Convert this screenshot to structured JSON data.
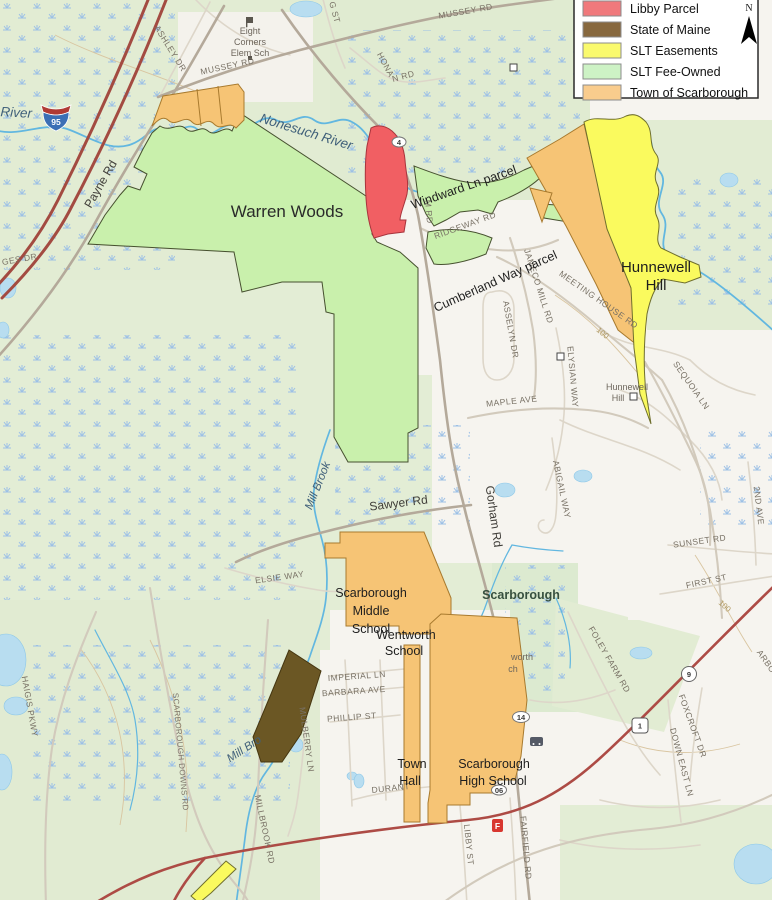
{
  "legend": {
    "items": [
      {
        "label": "Libby Parcel",
        "color": "#f0797c"
      },
      {
        "label": "State of Maine",
        "color": "#87683e"
      },
      {
        "label": "SLT Easements",
        "color": "#fafa6e"
      },
      {
        "label": "SLT Fee-Owned",
        "color": "#cdf2c5"
      },
      {
        "label": "Town of Scarborough",
        "color": "#f9cc8d"
      }
    ],
    "north_label": "N"
  },
  "map": {
    "parcel_labels": {
      "warren_woods": "Warren Woods",
      "windward_ln": "Windward Ln parcel",
      "cumberland_way": "Cumberland Way parcel",
      "hunnewell_hill": [
        "Hunnewell",
        "Hill"
      ],
      "middle_school": [
        "Scarborough",
        "Middle",
        "School"
      ],
      "wentworth_school": [
        "Wentworth",
        "School"
      ],
      "town_hall": [
        "Town",
        "Hall"
      ],
      "high_school": [
        "Scarborough",
        "High School"
      ]
    },
    "place_labels": {
      "eight_corners": [
        "Eight",
        "Corners",
        "Elem Sch"
      ],
      "hunnewell_hill_small": [
        "Hunnewell",
        "Hill"
      ],
      "scarborough_town": "Scarborough",
      "wentworth_fragment": [
        "worth",
        "ch"
      ],
      "contour_100": "100"
    },
    "water_labels": {
      "nonesuch_river": "Nonesuch River",
      "river_fragment": "River",
      "mill_brook": "Mill Brook",
      "mill_brook_fragment": "Mill Bro"
    },
    "road_labels": {
      "mussey": "MUSSEY RD",
      "ashley": "ASHLEY DR",
      "g_st": "G ST",
      "honan_1": "HONA",
      "honan_2": "N RD",
      "payne": "Payne Rd",
      "gorham": "Gorham Rd",
      "gorham_frag": "M RD",
      "ridgeway": "RIDGEWAY RD",
      "meeting_house": "MEETING HOUSE RD",
      "jameco": "JAMECO MILL RD",
      "asselyn": "ASSELYN DR",
      "elysian": "ELYSIAN WAY",
      "sequoia": "SEQUOIA LN",
      "maple": "MAPLE AVE",
      "abigail": "ABIGAIL WAY",
      "sawyer": "Sawyer Rd",
      "second_ave": "2ND AVE",
      "sunset": "SUNSET RD",
      "first_st": "FIRST ST",
      "elsie": "ELSIE WAY",
      "foley": "FOLEY FARM RD",
      "scarborough_downs": "SCARBOROUGH DOWNS RD",
      "haigis": "HAIGIS PKWY",
      "millbrook": "MILLBROOK RD",
      "mulberry": "MULBERRY LN",
      "imperial": "IMPERIAL LN",
      "barbara": "BARBARA AVE",
      "phillip": "PHILLIP ST",
      "durant": "DURANT",
      "libby_st": "LIBBY ST",
      "fairfield": "FAIRFIELD RD",
      "foxcroft": "FOXCROFT DR",
      "down_east": "DOWN EAST LN",
      "arbo_frag": "ARBO",
      "ges_frag": "GES DR"
    },
    "shields": {
      "i95": "95",
      "route1": "1",
      "route9": "9",
      "route114": "14",
      "route114_fragment": "4",
      "route_fragment_06": "06"
    },
    "icons": {
      "fire_station": "F"
    }
  }
}
